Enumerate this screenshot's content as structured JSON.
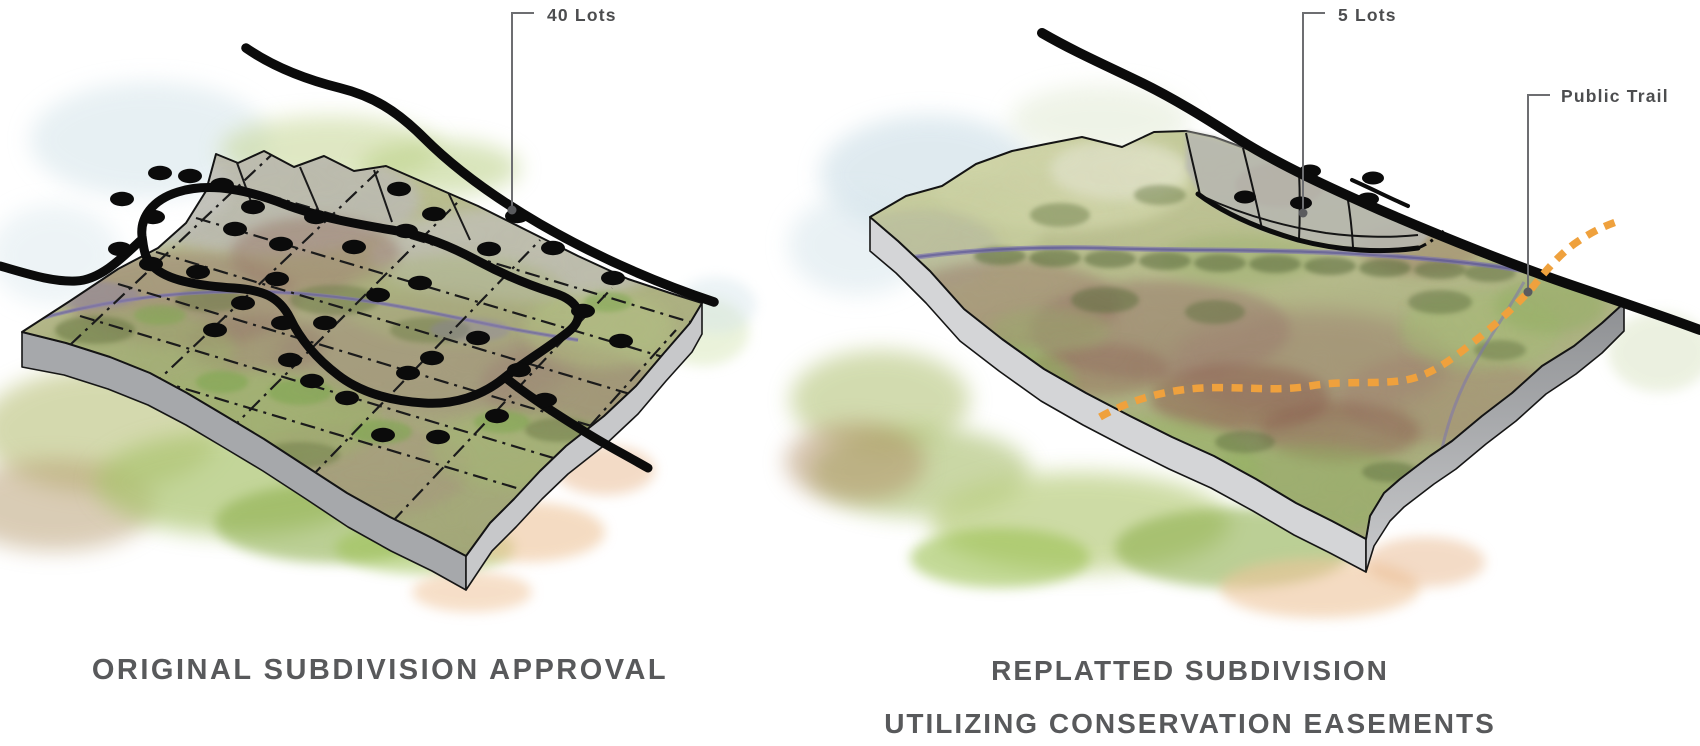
{
  "figure": {
    "description": "Watercolor comparison of two subdivision plans on the same parcel",
    "panels": {
      "left": {
        "caption": "ORIGINAL SUBDIVISION APPROVAL",
        "callouts": {
          "lots": "40 Lots"
        },
        "lot_count": 40
      },
      "right": {
        "caption_line1": "REPLATTED SUBDIVISION",
        "caption_line2": "UTILIZING CONSERVATION EASEMENTS",
        "callouts": {
          "lots": "5 Lots",
          "trail": "Public Trail"
        },
        "lot_count": 5
      }
    }
  },
  "colors": {
    "trail_orange": "#EFA13D",
    "road_black": "#0B0B0B",
    "caption_gray": "#58595B",
    "label_gray": "#4C4D4F",
    "leader_gray": "#6D6E71"
  }
}
